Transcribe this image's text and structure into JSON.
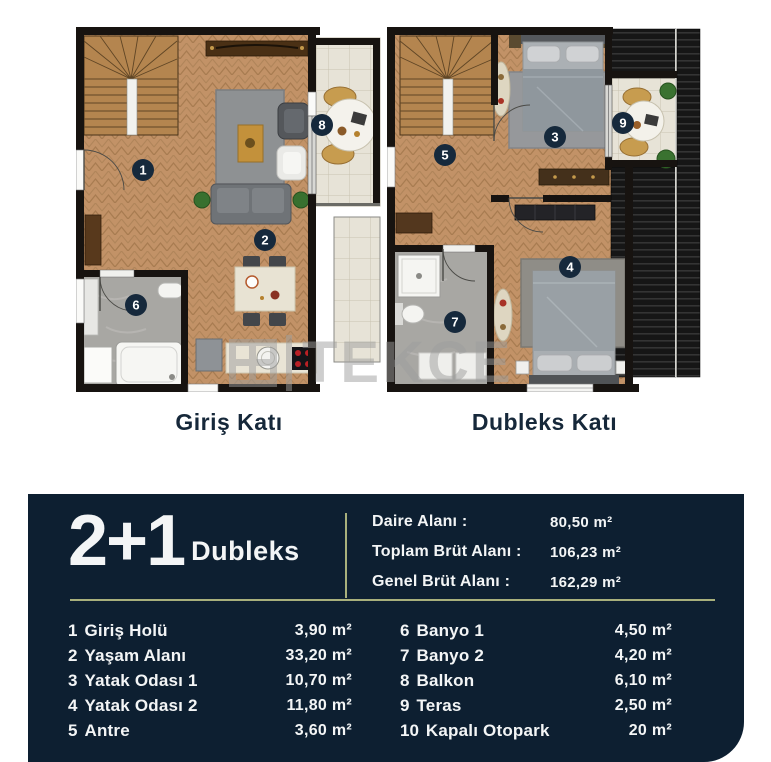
{
  "colors": {
    "panel_bg": "#0d1f31",
    "divider_olive": "#a8b07c",
    "badge_bg": "#16293c",
    "caption_text": "#16283a",
    "watermark_gray": "#9e9e9e",
    "wood_floor": "#c29267",
    "tile_floor": "#e7e3d7"
  },
  "watermark": {
    "logo_icon": "grid-square-icon",
    "text": "TEKCE"
  },
  "plans": [
    {
      "caption": "Giriş Katı",
      "badges": {
        "hall": "1",
        "living": "2",
        "bath1": "6",
        "balcony": "8"
      }
    },
    {
      "caption": "Dubleks Katı",
      "badges": {
        "bedroom1": "3",
        "bedroom2": "4",
        "antre": "5",
        "bath2": "7",
        "terrace": "9"
      }
    }
  ],
  "panel": {
    "unit_number": "2+1",
    "unit_label": "Dubleks",
    "summary": [
      {
        "label": "Daire Alanı :",
        "value": "80,50 m²"
      },
      {
        "label": "Toplam Brüt Alanı :",
        "value": "106,23 m²"
      },
      {
        "label": "Genel Brüt Alanı :",
        "value": "162,29 m²"
      }
    ],
    "rooms_left": [
      {
        "no": "1",
        "name": "Giriş Holü",
        "area": "3,90 m²"
      },
      {
        "no": "2",
        "name": "Yaşam Alanı",
        "area": "33,20 m²"
      },
      {
        "no": "3",
        "name": "Yatak Odası 1",
        "area": "10,70 m²"
      },
      {
        "no": "4",
        "name": "Yatak Odası 2",
        "area": "11,80 m²"
      },
      {
        "no": "5",
        "name": "Antre",
        "area": "3,60 m²"
      }
    ],
    "rooms_right": [
      {
        "no": "6",
        "name": "Banyo 1",
        "area": "4,50 m²"
      },
      {
        "no": "7",
        "name": "Banyo 2",
        "area": "4,20 m²"
      },
      {
        "no": "8",
        "name": "Balkon",
        "area": "6,10 m²"
      },
      {
        "no": "9",
        "name": "Teras",
        "area": "2,50 m²"
      },
      {
        "no": "10",
        "name": "Kapalı Otopark",
        "area": "20 m²"
      }
    ]
  }
}
